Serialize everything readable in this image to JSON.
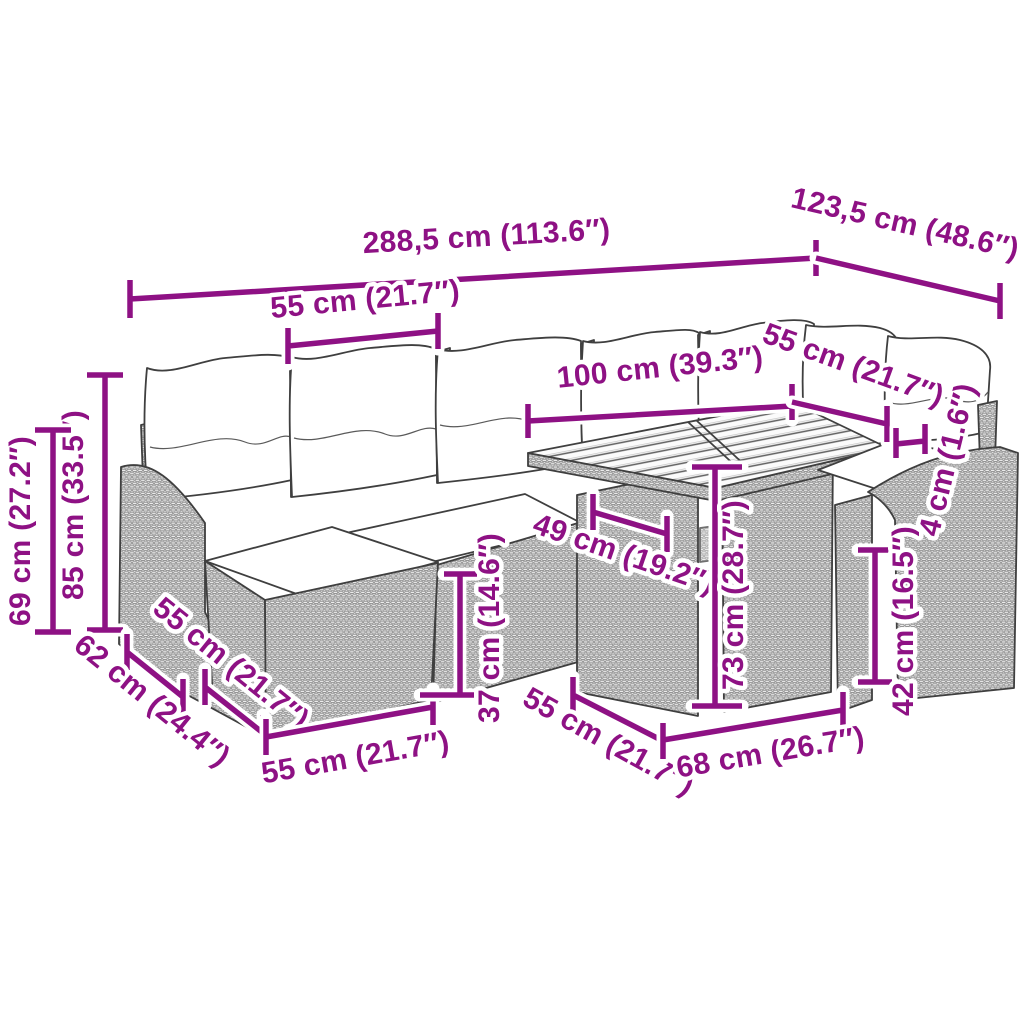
{
  "title": "Garden lounge set with table — dimension diagram",
  "colors": {
    "dimension_accent": "#8E1184",
    "line_art": "#3F3F3F",
    "background": "#FFFFFF"
  },
  "dimensions": {
    "overall_width": {
      "label": "288,5 cm (113.6″)"
    },
    "overall_depth": {
      "label": "123,5 cm (48.6″)"
    },
    "seat_module_width": {
      "label": "55 cm (21.7″)"
    },
    "table_length": {
      "label": "100 cm (39.3″)"
    },
    "table_depth_right": {
      "label": "55 cm (21.7″)"
    },
    "tabletop_thickness": {
      "label": "4 cm (1.6″)"
    },
    "total_height": {
      "label": "85 cm (33.5″)"
    },
    "backrest_height": {
      "label": "69 cm (27.2″)"
    },
    "corner_depth": {
      "label": "62 cm (24.4″)"
    },
    "ottoman_depth": {
      "label": "55 cm (21.7″)"
    },
    "ottoman_width": {
      "label": "55 cm (21.7″)"
    },
    "seat_height": {
      "label": "37 cm (14.6″)"
    },
    "table_panel_depth": {
      "label": "49 cm (19.2″)"
    },
    "table_height": {
      "label": "73 cm (28.7″)"
    },
    "table_base_depth": {
      "label": "55 cm (21.7″)"
    },
    "table_base_width": {
      "label": "68 cm (26.7″)"
    },
    "side_height": {
      "label": "42 cm (16.5″)"
    }
  }
}
